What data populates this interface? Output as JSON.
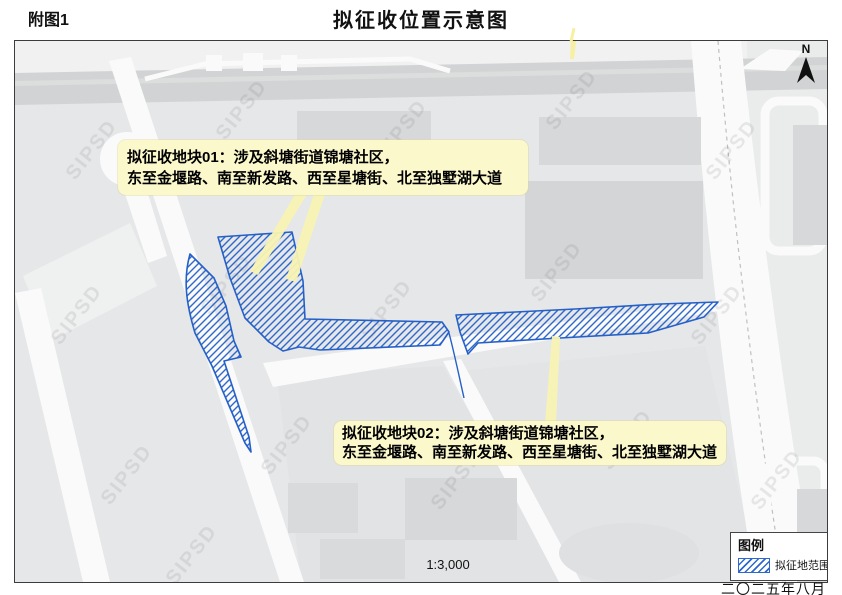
{
  "header": {
    "fig_label": "附图1",
    "title": "拟征收位置示意图"
  },
  "map": {
    "north_label": "N",
    "scale_text": "1:3,000",
    "watermark": "SIPSD",
    "callout_01": {
      "line1": "拟征收地块01：涉及斜塘街道锦塘社区，",
      "line2": "东至金堰路、南至新发路、西至星塘街、北至独墅湖大道"
    },
    "callout_02": {
      "line1": "拟征收地块02：涉及斜塘街道锦塘社区，",
      "line2": "东至金堰路、南至新发路、西至星塘街、北至独墅湖大道"
    }
  },
  "legend": {
    "title": "图例",
    "items": [
      {
        "swatch": "blue-diagonal-hatch",
        "label": "拟征地范围"
      }
    ]
  },
  "footer": {
    "date": "二〇二五年八月"
  },
  "colors": {
    "hatch_blue": "#2f68cc",
    "hatch_border_blue": "#2560c8",
    "callout_yellow": "#fbf8cc",
    "map_base_gray": "#e6e7e8",
    "road_white": "#fafafa",
    "building_gray": "#d7d8d9",
    "major_road_gray": "#d2d3d4"
  }
}
